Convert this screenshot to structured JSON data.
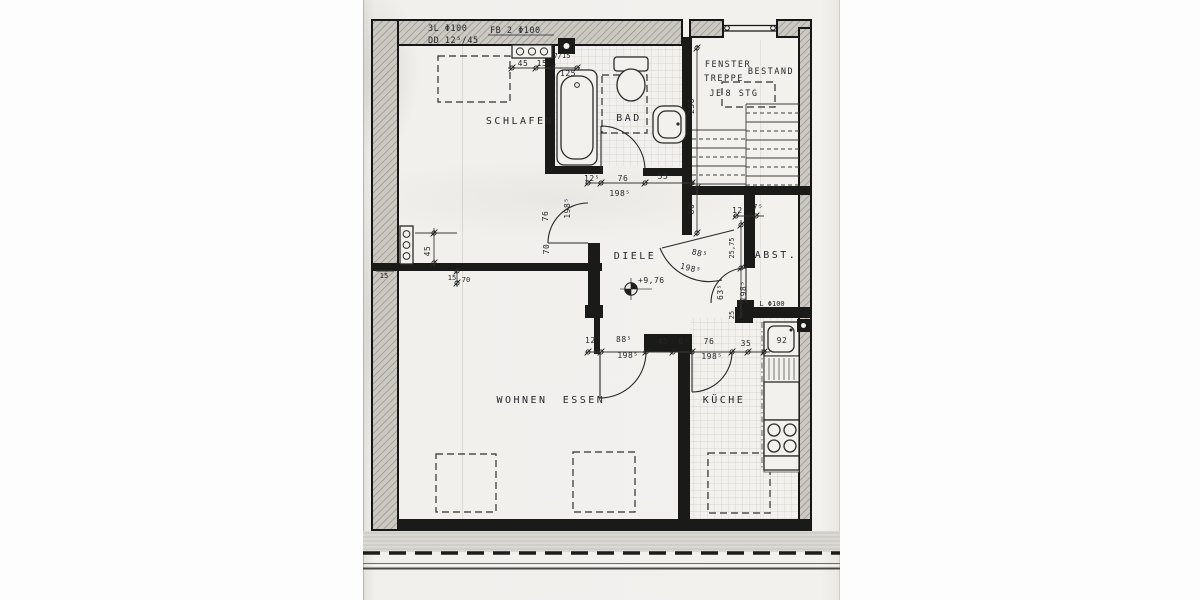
{
  "notes": {
    "pipe_left": "3L Φ100",
    "pipe_left2": "DD 12⁵/45",
    "pipe_bath": "FB 2 Φ100",
    "pipe_kitchen": "L Φ100",
    "level": "+9,76",
    "sink": "92"
  },
  "rooms": {
    "bedroom": "SCHLAFEN",
    "bath": "BAD",
    "hall": "DIELE",
    "storage": "ABST.",
    "living": "WOHNEN",
    "dining": "ESSEN",
    "kitchen": "KÜCHE"
  },
  "stairwell": {
    "line1": "FENSTER",
    "line2": "TREPPE",
    "line3": "BESTAND",
    "line4a": "JE",
    "line4b": "8 STG"
  },
  "dims": {
    "top_45": "45",
    "top_15": "15",
    "top_125": "125",
    "top_7_15": "7/15",
    "stair_250": "250",
    "hall_80": "80",
    "bath_12": "12⁵",
    "bath_76": "76",
    "bath_55": "55",
    "bath_198": "198⁵",
    "bed_door_76": "76",
    "bed_door_198": "198⁵",
    "bed_70": "70",
    "left_45": "45",
    "left_15": "15",
    "left_15b": "15",
    "left_70": "70",
    "abst_12": "12⁵",
    "abst_7": "7⁵",
    "abst_2575": "25,75",
    "abst_63": "63⁵",
    "abst_198": "198⁵",
    "abst_25": "25",
    "entry_88": "88⁵",
    "entry_198": "198⁵",
    "south_12": "12⁵",
    "south_88": "88⁵",
    "south_198a": "198⁵",
    "south_45": "45",
    "south_6": "6⁵",
    "south_76": "76",
    "south_198b": "198⁵",
    "south_35": "35"
  }
}
